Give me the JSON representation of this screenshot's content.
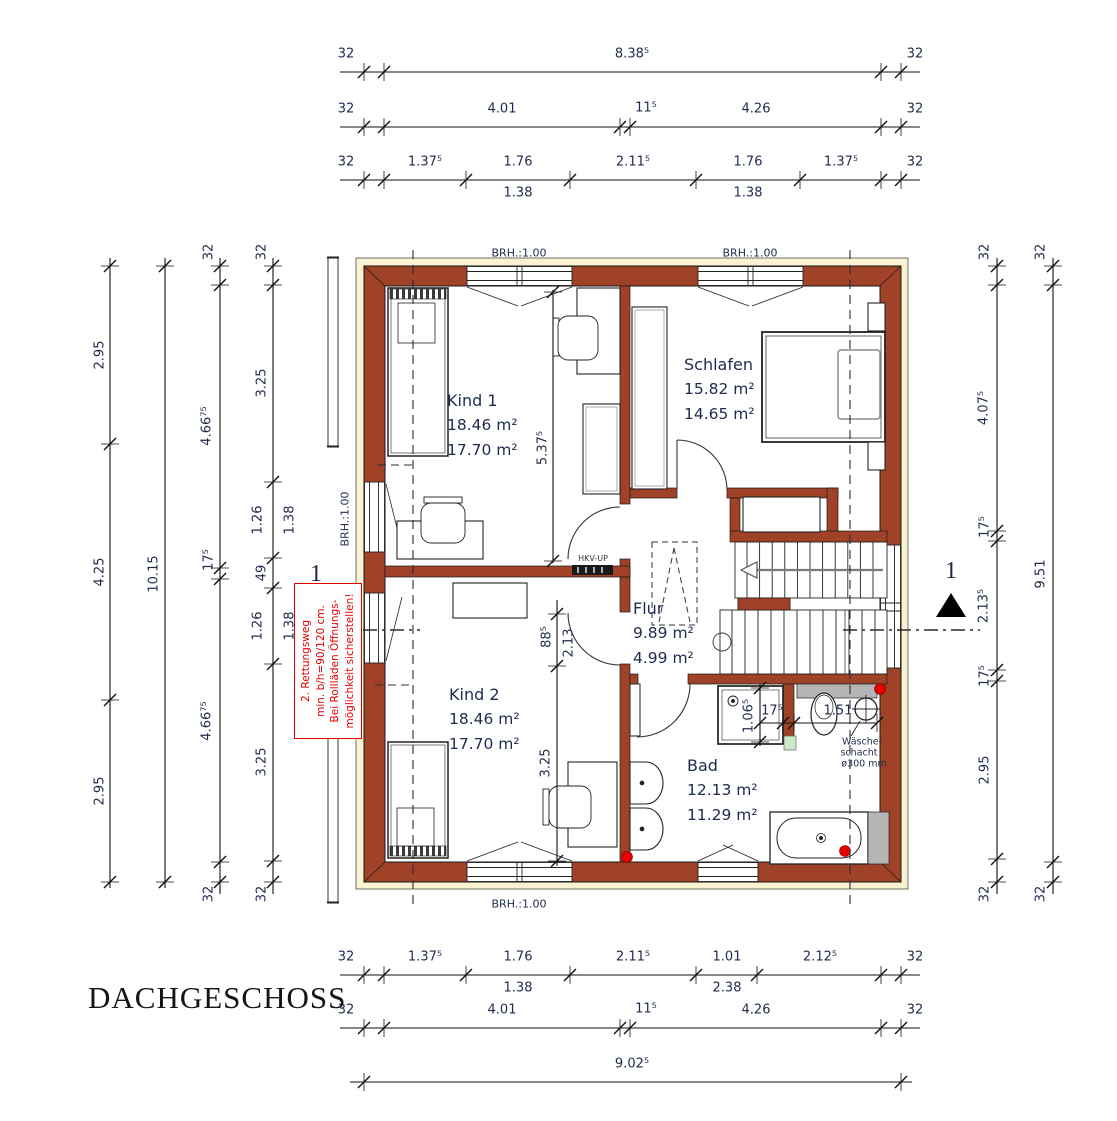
{
  "title": "DACHGESCHOSS",
  "rooms": {
    "kind1": {
      "name": "Kind 1",
      "area_gross": "18.46 m²",
      "area_net": "17.70 m²"
    },
    "schlafen": {
      "name": "Schlafen",
      "area_gross": "15.82 m²",
      "area_net": "14.65 m²"
    },
    "flur": {
      "name": "Flur",
      "area_gross": "9.89 m²",
      "area_net": "4.99 m²"
    },
    "kind2": {
      "name": "Kind 2",
      "area_gross": "18.46 m²",
      "area_net": "17.70 m²"
    },
    "bad": {
      "name": "Bad",
      "area_gross": "12.13 m²",
      "area_net": "11.29 m²"
    }
  },
  "warning": {
    "line1": "2. Rettungsweg",
    "line2": "min. b/h=90/120 cm.",
    "line3": "Bei Rollläden Öffnungs-",
    "line4": "möglichkeit sicherstellen!"
  },
  "colors": {
    "wall": "#9f4228",
    "eave": "#faf3d3",
    "accent_red": "#e60000",
    "gray_fixture": "#b5b5b5",
    "green_marker": "#cde9cc",
    "text": "#1f2b4d"
  },
  "labels": [
    {
      "t": "32",
      "x": 346,
      "y": 54
    },
    {
      "t": "8.38⁵",
      "x": 632,
      "y": 54
    },
    {
      "t": "32",
      "x": 915,
      "y": 54
    },
    {
      "t": "32",
      "x": 346,
      "y": 109
    },
    {
      "t": "4.01",
      "x": 502,
      "y": 109
    },
    {
      "t": "11⁵",
      "x": 646,
      "y": 108
    },
    {
      "t": "4.26",
      "x": 756,
      "y": 109
    },
    {
      "t": "32",
      "x": 915,
      "y": 109
    },
    {
      "t": "32",
      "x": 346,
      "y": 162
    },
    {
      "t": "1.37⁵",
      "x": 425,
      "y": 162
    },
    {
      "t": "1.76",
      "x": 518,
      "y": 162
    },
    {
      "t": "2.11⁵",
      "x": 633,
      "y": 162
    },
    {
      "t": "1.76",
      "x": 748,
      "y": 162
    },
    {
      "t": "1.37⁵",
      "x": 841,
      "y": 162
    },
    {
      "t": "32",
      "x": 915,
      "y": 162
    },
    {
      "t": "1.38",
      "x": 518,
      "y": 193
    },
    {
      "t": "1.38",
      "x": 748,
      "y": 193
    },
    {
      "t": "32",
      "x": 346,
      "y": 957
    },
    {
      "t": "1.37⁵",
      "x": 425,
      "y": 957
    },
    {
      "t": "1.76",
      "x": 518,
      "y": 957
    },
    {
      "t": "2.11⁵",
      "x": 633,
      "y": 957
    },
    {
      "t": "1.01",
      "x": 727,
      "y": 957
    },
    {
      "t": "2.12⁵",
      "x": 820,
      "y": 957
    },
    {
      "t": "32",
      "x": 915,
      "y": 957
    },
    {
      "t": "1.38",
      "x": 518,
      "y": 988
    },
    {
      "t": "2.38",
      "x": 727,
      "y": 988
    },
    {
      "t": "32",
      "x": 346,
      "y": 1010
    },
    {
      "t": "4.01",
      "x": 502,
      "y": 1010
    },
    {
      "t": "11⁵",
      "x": 646,
      "y": 1009
    },
    {
      "t": "4.26",
      "x": 756,
      "y": 1010
    },
    {
      "t": "32",
      "x": 915,
      "y": 1010
    },
    {
      "t": "9.02⁵",
      "x": 632,
      "y": 1064
    },
    {
      "t": "2.95",
      "x": 100,
      "y": 355,
      "r": 1
    },
    {
      "t": "4.25",
      "x": 100,
      "y": 572,
      "r": 1
    },
    {
      "t": "2.95",
      "x": 100,
      "y": 791,
      "r": 1
    },
    {
      "t": "10.15",
      "x": 154,
      "y": 574,
      "r": 1
    },
    {
      "t": "32",
      "x": 209,
      "y": 252,
      "r": 1
    },
    {
      "t": "4.66⁷⁵",
      "x": 207,
      "y": 426,
      "r": 1
    },
    {
      "t": "17⁵",
      "x": 209,
      "y": 560,
      "r": 1
    },
    {
      "t": "4.66⁷⁵",
      "x": 207,
      "y": 721,
      "r": 1
    },
    {
      "t": "32",
      "x": 209,
      "y": 894,
      "r": 1
    },
    {
      "t": "32",
      "x": 262,
      "y": 252,
      "r": 1
    },
    {
      "t": "3.25",
      "x": 262,
      "y": 383,
      "r": 1
    },
    {
      "t": "1.26",
      "x": 258,
      "y": 520,
      "r": 1
    },
    {
      "t": "1.38",
      "x": 290,
      "y": 520,
      "r": 1
    },
    {
      "t": "49",
      "x": 262,
      "y": 573,
      "r": 1
    },
    {
      "t": "1.26",
      "x": 258,
      "y": 626,
      "r": 1
    },
    {
      "t": "1.38",
      "x": 290,
      "y": 626,
      "r": 1
    },
    {
      "t": "3.25",
      "x": 262,
      "y": 762,
      "r": 1
    },
    {
      "t": "32",
      "x": 262,
      "y": 894,
      "r": 1
    },
    {
      "t": "32",
      "x": 985,
      "y": 252,
      "r": 1
    },
    {
      "t": "4.07⁵",
      "x": 984,
      "y": 408,
      "r": 1
    },
    {
      "t": "17⁵",
      "x": 985,
      "y": 527,
      "r": 1
    },
    {
      "t": "2.13⁵",
      "x": 984,
      "y": 606,
      "r": 1
    },
    {
      "t": "17⁵",
      "x": 985,
      "y": 676,
      "r": 1
    },
    {
      "t": "2.95",
      "x": 985,
      "y": 770,
      "r": 1
    },
    {
      "t": "32",
      "x": 985,
      "y": 894,
      "r": 1
    },
    {
      "t": "32",
      "x": 1041,
      "y": 252,
      "r": 1
    },
    {
      "t": "9.51",
      "x": 1041,
      "y": 574,
      "r": 1
    },
    {
      "t": "32",
      "x": 1041,
      "y": 894,
      "r": 1
    },
    {
      "t": "5.37⁵",
      "x": 543,
      "y": 448,
      "r": 1
    },
    {
      "t": "88⁵",
      "x": 547,
      "y": 637,
      "r": 1
    },
    {
      "t": "2.13",
      "x": 569,
      "y": 643,
      "r": 1
    },
    {
      "t": "3.25",
      "x": 546,
      "y": 763,
      "r": 1
    },
    {
      "t": "1.06⁵",
      "x": 749,
      "y": 716,
      "r": 1
    },
    {
      "t": "17⁵",
      "x": 772,
      "y": 711
    },
    {
      "t": "1.51",
      "x": 838,
      "y": 711
    },
    {
      "t": "BRH.:1.00",
      "x": 519,
      "y": 253,
      "c": "b"
    },
    {
      "t": "BRH.:1.00",
      "x": 750,
      "y": 253,
      "c": "b"
    },
    {
      "t": "BRH.:1.00",
      "x": 519,
      "y": 904,
      "c": "b"
    },
    {
      "t": "BRH.:1.00",
      "x": 345,
      "y": 519,
      "r": 1,
      "c": "b"
    },
    {
      "t": "1",
      "x": 316,
      "y": 574,
      "c": "m"
    },
    {
      "t": "1",
      "x": 951,
      "y": 571,
      "c": "m"
    },
    {
      "t": "HKV-UP",
      "x": 593,
      "y": 559,
      "c": "t"
    },
    {
      "t": "Wäsche-",
      "x": 862,
      "y": 742,
      "c": "w"
    },
    {
      "t": "schacht",
      "x": 859,
      "y": 753,
      "c": "w"
    },
    {
      "t": "ø300 mm",
      "x": 864,
      "y": 764,
      "c": "w"
    }
  ]
}
